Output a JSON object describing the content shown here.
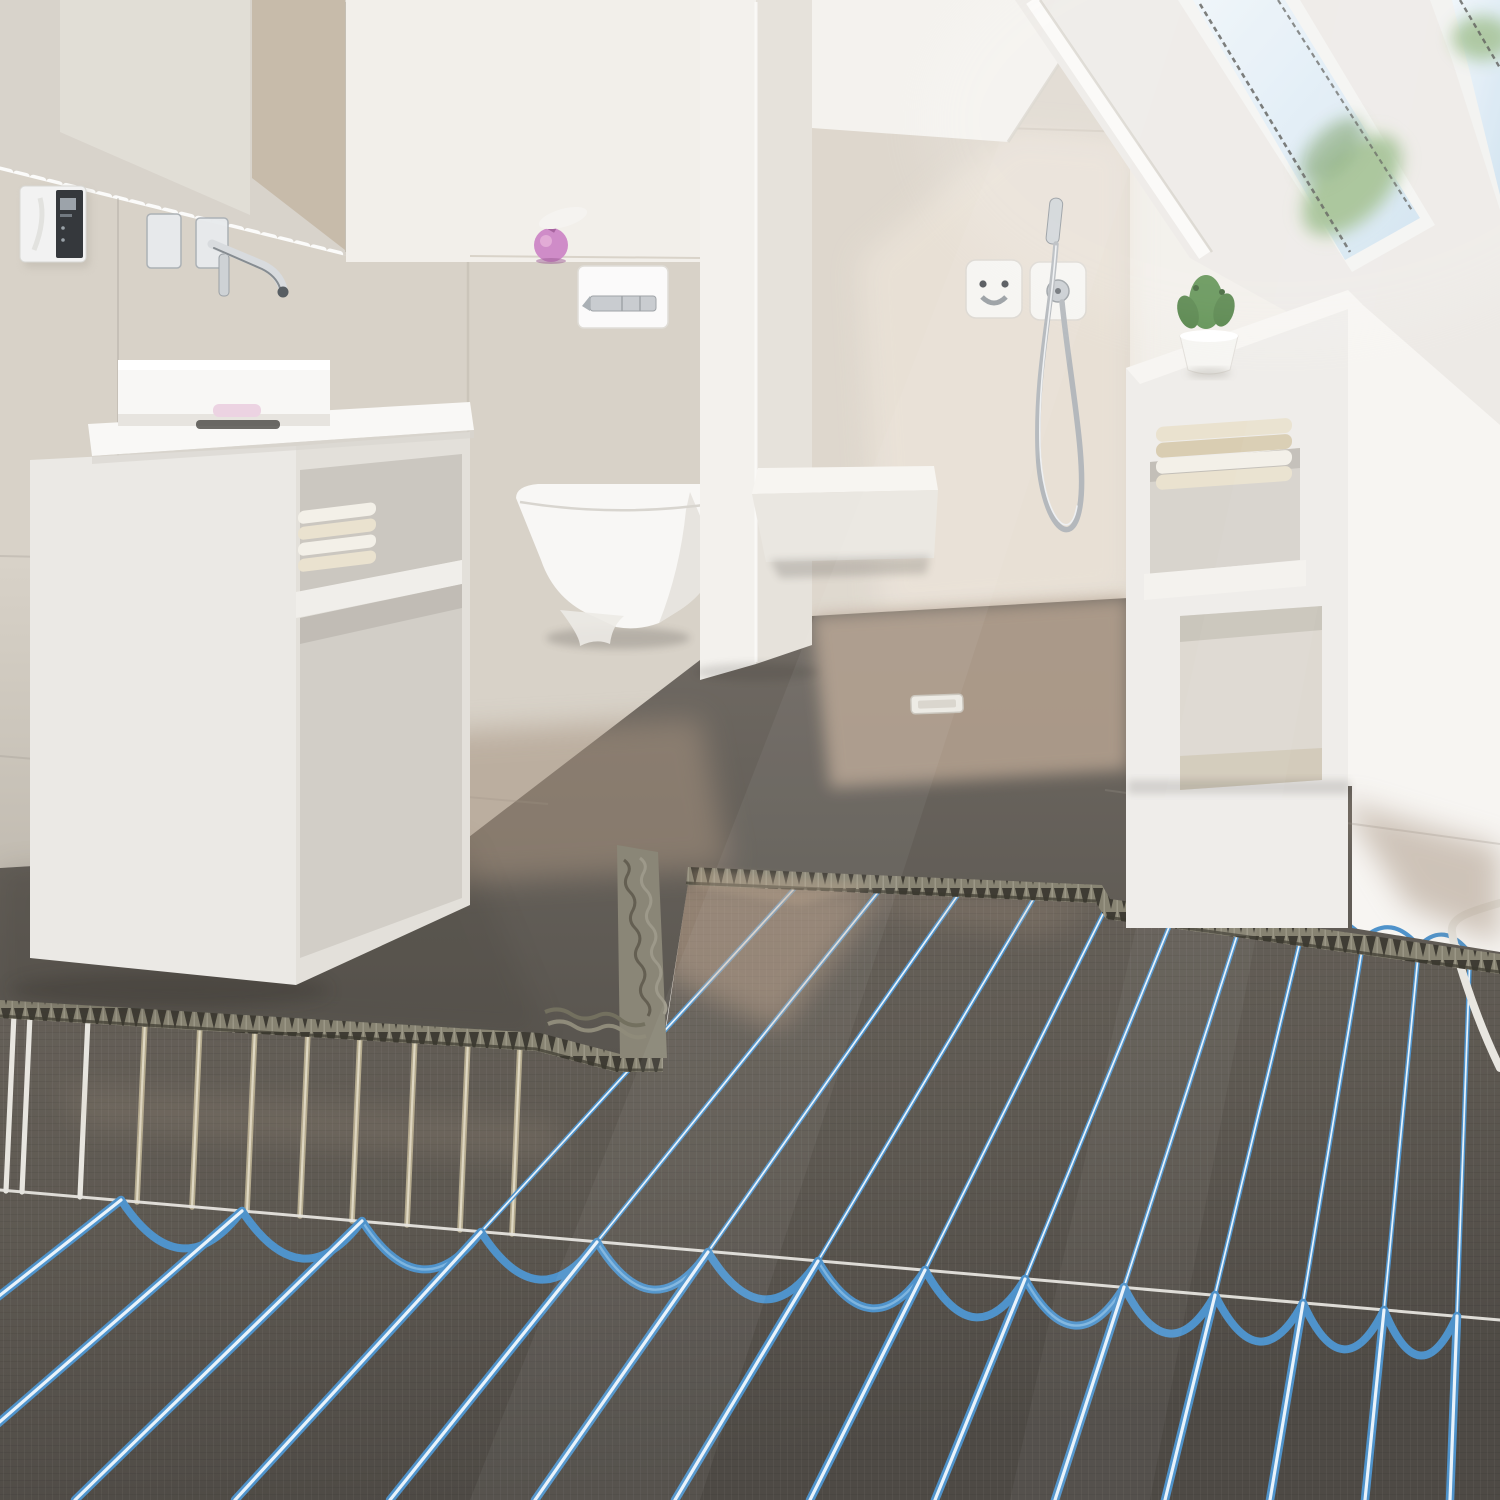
{
  "scene": {
    "description": "Photorealistic render of an attic bathroom; foreground floor opened up showing electric underfloor heating mats with blue heating cables, tan cables and combed tile adhesive where the grey floor tiles end",
    "room": "bathroom",
    "text_visible": "none"
  },
  "objects": {
    "mirror": "large wall mirror",
    "thermostat": "wall thermostat with dark display panel",
    "faucet": "chrome wall-mounted basin spout with two escutcheon plates",
    "basin": "white rectangular counter-top basin",
    "soap_dish": "soap dish on basin edge",
    "vanity": "floating white vanity cabinet with two open niches",
    "vanity_towels": "folded towels in vanity niche",
    "soap_dispenser": "pink soap dispenser on wall ledge",
    "flush_plate": "white toilet flush plate with chrome buttons",
    "toilet": "white wall-hung toilet",
    "partition": "white partition wall",
    "shower_valve_left": "shower outlet with hose connection",
    "shower_valve_right": "shower mixer valve with chrome handle",
    "hand_shower": "chrome hand shower hanging on coiled hose",
    "bench": "white shower bench",
    "gable": "white attic gable wall",
    "skylight_left": "sloped roof window with sky and foliage",
    "skylight_right": "second roof window at corner",
    "shelf_unit": "built-in white shelf unit under the roof slope",
    "cactus": "green cactus in white pot",
    "shelf_towels": "stack of folded cream towels",
    "floor_tiles": "large dark grey floor tiles",
    "sunlit_floor": "sunlit beige patches on floor",
    "floor_drain": "rectangular floor drain",
    "mortar_edge": "combed tile-adhesive ridge at tile edge",
    "heating_mat": "dark grey heating mat underlay",
    "cables_blue": "blue heating cables in serpentine loops",
    "cables_tan": "tan heating cables of left mat section",
    "cables_white": "white cables at mat edges",
    "mat_seam": "white joint cord between mat rows"
  },
  "colors": {
    "wall_white": "#f2efea",
    "wall_upper_right": "#f7f5f2",
    "mirror_light": "#dedad3",
    "mirror_beige": "#c7bbaa",
    "wall_tile_beige": "#d8d2c8",
    "shower_wall": "#ded7cd",
    "shower_wall_lit": "#ece4d9",
    "roof_plane": "#edeae6",
    "gable_white": "#f4f2ee",
    "partition_white": "#f3f1ed",
    "sky_blue": "#d7e6f1",
    "sky_pale": "#eef5fa",
    "foliage_green": "#9dbd8d",
    "foliage_dark": "#7da26e",
    "porcelain": "#f8f7f5",
    "porcelain_shadow": "#dddad4",
    "chrome": "#c3c7cb",
    "chrome_dark": "#8f959a",
    "soap_pink": "#cf8cc8",
    "soap_pink_dark": "#a7639f",
    "cactus_green": "#5f9152",
    "pot_white": "#f6f5f2",
    "towel_cream": "#eae2cf",
    "towel_white": "#f3f0e8",
    "towel_beige": "#d9cdb2",
    "floor_tile": "#67625c",
    "floor_tile_dark": "#56524d",
    "floor_sunlit": "#b3a090",
    "mortar": "#8a8677",
    "mortar_dark": "#4a473f",
    "mat": "#5e5952",
    "mat_dark": "#4b4742",
    "cable_blue": "#4f93cb",
    "cable_core": "#e9f3fb",
    "cable_tan": "#b4aa8e",
    "cable_tan_core": "#e0d9c4",
    "cable_white": "#e8e6e0",
    "seam_white": "#e6e4de",
    "drain_white": "#eceae4",
    "thermostat_body": "#f2f2f2",
    "thermostat_panel": "#35383c"
  }
}
